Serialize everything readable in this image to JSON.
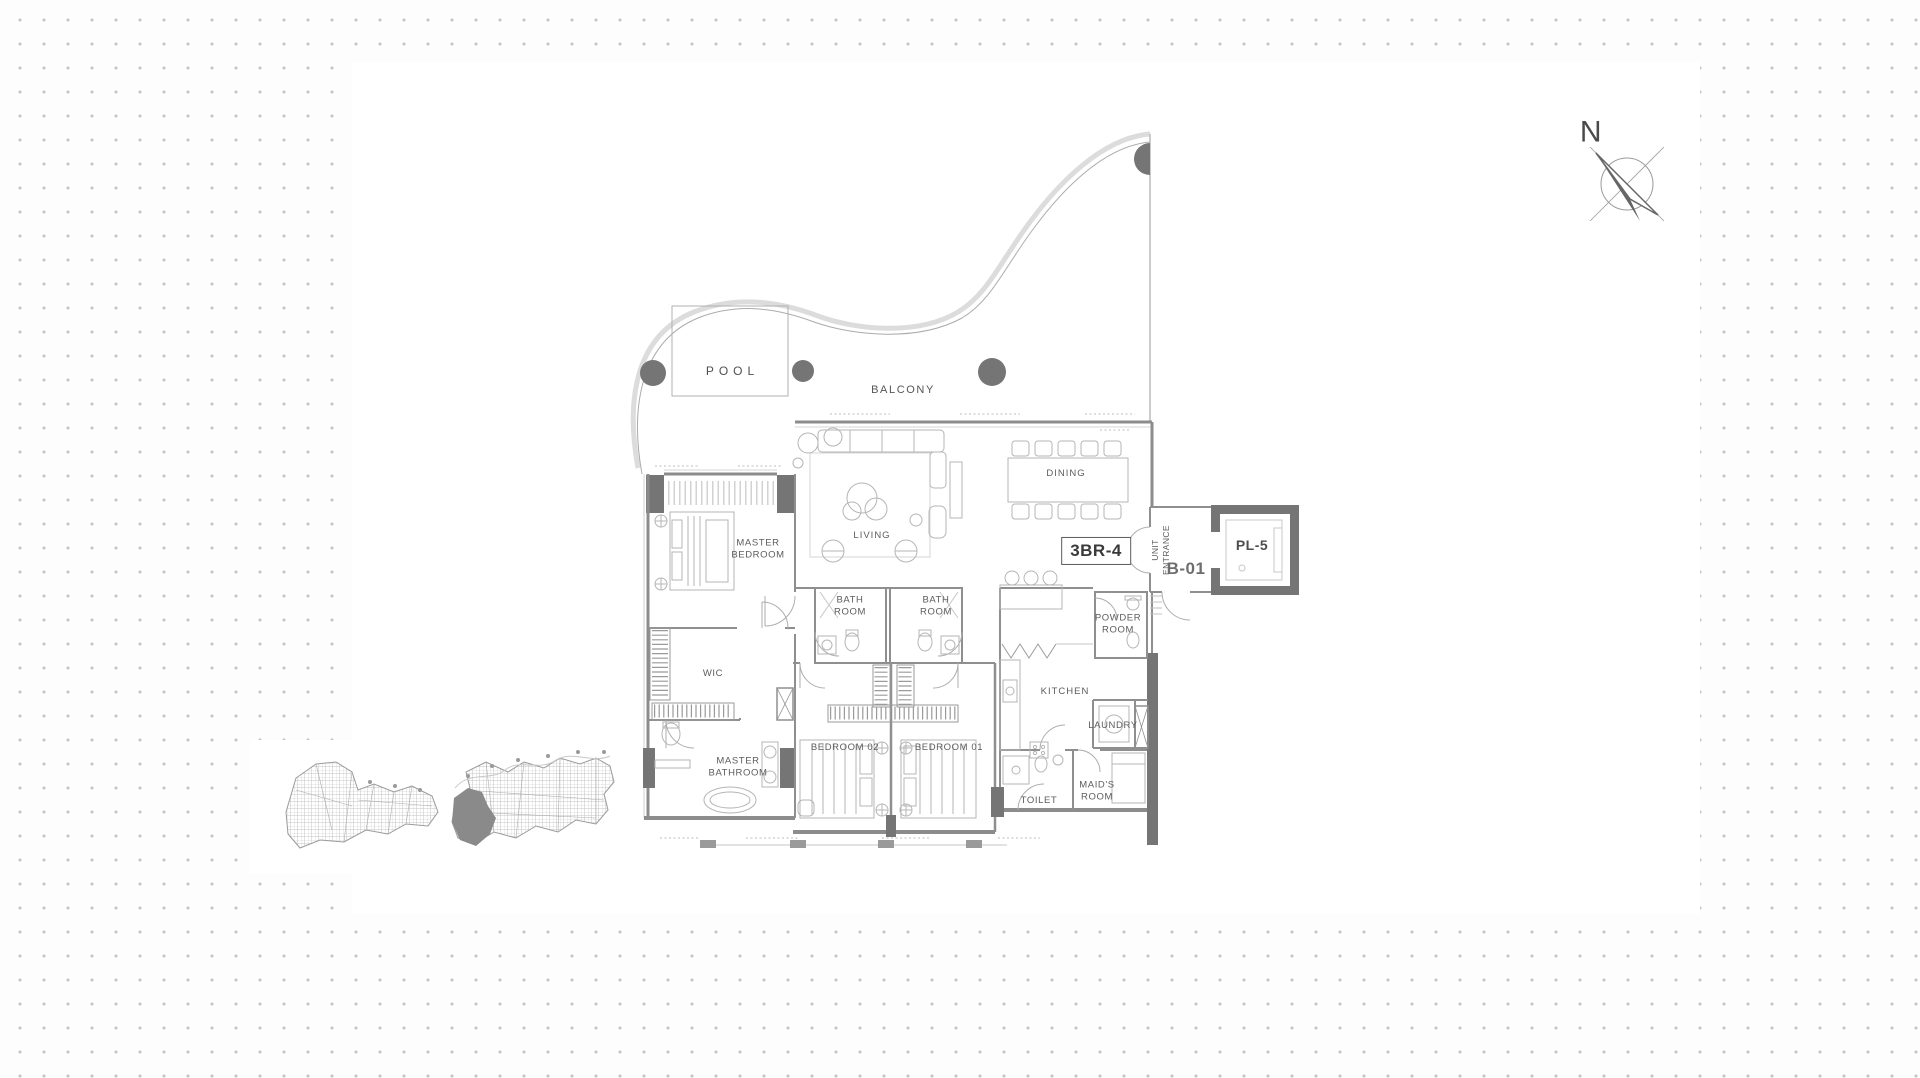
{
  "plan": {
    "unit_type": "3BR-4",
    "unit_number": "B-01",
    "lift_label": "PL-5",
    "entrance_label": "UNIT\nENTRANCE",
    "rooms": {
      "pool": "POOL",
      "balcony": "BALCONY",
      "living": "LIVING",
      "dining": "DINING",
      "master_bedroom": "MASTER\nBEDROOM",
      "bath_room_1": "BATH\nROOM",
      "bath_room_2": "BATH\nROOM",
      "powder_room": "POWDER\nROOM",
      "wic": "WIC",
      "kitchen": "KITCHEN",
      "laundry": "LAUNDRY",
      "master_bathroom": "MASTER\nBATHROOM",
      "bedroom_02": "BEDROOM 02",
      "bedroom_01": "BEDROOM 01",
      "toilet": "TOILET",
      "maids_room": "MAID'S\nROOM"
    }
  },
  "compass": {
    "north_label": "N"
  },
  "colors": {
    "wall": "#8c8c8c",
    "structure_fill": "#757575",
    "furniture_line": "#b5b5b5",
    "label_text": "#5c5c5c",
    "background_dot": "#c7c7c7"
  }
}
